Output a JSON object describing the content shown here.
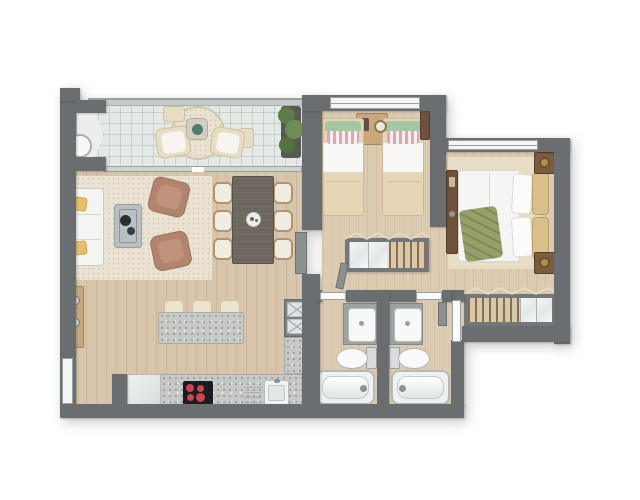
{
  "title": "Apartment floor plan, top-down architectural rendering, two bedrooms, two bathrooms, balcony, open kitchen and living-dining area",
  "colors": {
    "wall": "#6b6e70",
    "wood": "#d8c5ab",
    "wood_light": "#ddcbb1",
    "tile": "#e4e9e6",
    "rug": "#eae3d3",
    "granite": "#c7c9c7",
    "mauve": "#b2846e",
    "mustard": "#e5c06c",
    "wood_dark": "#6e523c",
    "table_dark": "#6e675f",
    "bed_beige": "#e6d6b6",
    "pillow_green": "#a4c6a2",
    "pillow_pink": "#e2a4b2",
    "olive": "#97a06b",
    "tan_pillow": "#d9c08a",
    "plant": "#5e7b4a",
    "burner_red": "#c94550"
  },
  "plan": {
    "rooms": [
      "balcony",
      "living-room",
      "dining-area",
      "kitchen",
      "hallway",
      "kids-bedroom",
      "master-bedroom",
      "bathroom-left",
      "bathroom-right",
      "entry"
    ],
    "furniture": [
      "sofa",
      "coffee-table",
      "armchair",
      "dining-table",
      "dining-chair",
      "kitchen-island",
      "bar-stool",
      "fridge",
      "cooktop",
      "kitchen-sink",
      "pantry-cabinet",
      "coat-rack",
      "single-bed",
      "double-bed",
      "nightstand",
      "wardrobe-closet",
      "vanity-sink",
      "toilet",
      "bathtub",
      "balcony-chair",
      "balcony-table",
      "round-rug",
      "planter",
      "plant"
    ]
  }
}
